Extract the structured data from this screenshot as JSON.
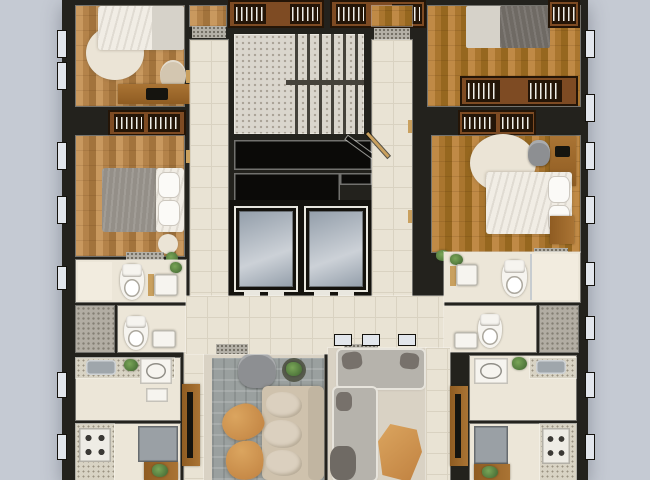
{
  "scene": {
    "type": "residential-floor-plan-3d-top-view",
    "core": {
      "features": [
        "staircase-two-flights",
        "stair-void",
        "elevator-shaft",
        "elevator-shaft"
      ],
      "elevator_count": 2
    },
    "circulation": [
      "left-corridor",
      "right-corridor",
      "lobby",
      "door-mats",
      "open-door-leaf"
    ],
    "rooms": [
      {
        "name": "bedroom-top-left",
        "furniture": [
          "double-bed",
          "round-rug",
          "desk",
          "laptop",
          "desk-chair",
          "plant"
        ]
      },
      {
        "name": "bedroom-mid-left",
        "furniture": [
          "wardrobe-hangers",
          "double-bed-gray-blanket",
          "stool",
          "plant",
          "door-mat"
        ]
      },
      {
        "name": "bathroom-left-1",
        "furniture": [
          "shower",
          "toilet",
          "vanity-sink",
          "plant"
        ]
      },
      {
        "name": "bathroom-left-2",
        "furniture": [
          "toilet",
          "vanity-sink"
        ]
      },
      {
        "name": "laundry-left",
        "furniture": [
          "counter",
          "steel-sink",
          "plant",
          "washer",
          "appliance"
        ]
      },
      {
        "name": "kitchen-left",
        "furniture": [
          "counter",
          "stove-4-burners",
          "fridge",
          "plant-stand"
        ]
      },
      {
        "name": "living-room-left",
        "furniture": [
          "plaid-rug",
          "armchair",
          "plant-table",
          "three-seat-sofa",
          "coffee-table",
          "coffee-table",
          "tv-console",
          "tv"
        ]
      },
      {
        "name": "living-room-right",
        "furniture": [
          "l-shaped-sofa",
          "pillows",
          "coffee-table",
          "lounge-chair",
          "tv-console",
          "tv"
        ]
      },
      {
        "name": "bedroom-top-right",
        "furniture": [
          "double-bed-dark-blanket",
          "wardrobe-hangers",
          "corner-closet"
        ]
      },
      {
        "name": "bedroom-mid-right",
        "furniture": [
          "wardrobe-hangers",
          "round-rug",
          "double-bed",
          "desk",
          "laptop",
          "desk-chair",
          "nightstand",
          "plant",
          "door-mat"
        ]
      },
      {
        "name": "bathroom-right-1",
        "furniture": [
          "plant",
          "vanity-sink",
          "toilet",
          "glass-shower"
        ]
      },
      {
        "name": "bathroom-right-2",
        "furniture": [
          "toilet",
          "vanity-sink"
        ]
      },
      {
        "name": "laundry-right",
        "furniture": [
          "washer",
          "plant",
          "counter",
          "steel-sink"
        ]
      },
      {
        "name": "kitchen-right",
        "furniture": [
          "fridge",
          "stove-4-burners",
          "counter",
          "plant-stand"
        ]
      },
      {
        "name": "service-shaft-left",
        "furniture": []
      },
      {
        "name": "service-shaft-right",
        "furniture": []
      },
      {
        "name": "top-center-closet-left",
        "furniture": [
          "wardrobe-hangers"
        ]
      },
      {
        "name": "top-center-closet-right",
        "furniture": [
          "wardrobe-hangers"
        ]
      }
    ],
    "window_count": 16
  },
  "palette": {
    "bg": "#c5cad3",
    "wall": "#23221d",
    "wallDeep": "#14120d",
    "tile": "#e9e3d4",
    "tileLine": "#d9d2c1",
    "cream": "#ece6d8",
    "cream2": "#f2ecdf",
    "terrazzo": "#dad6cd",
    "terrazzoDot": "#a7a093",
    "tread": "#45423b",
    "voidBlack": "#0b0a08",
    "elevFrame": "#e9e7df",
    "elevCarA": "#939eaa",
    "elevCarB": "#ccd1d7",
    "cabinet": "#7e4b23",
    "cabinetDark": "#241507",
    "jamb": "#c9a05e",
    "mat": "#b4b0a7",
    "matDot": "#716d63",
    "counter": "#d8d3c4",
    "shaft": "#b2ada3",
    "shaftDot": "#847f74",
    "winGlass": "#e2e6ec",
    "porcelain": "#f6f4ef",
    "steel": "#9fa6ab",
    "appliance": "#eeece5",
    "applianceEdge": "#c5c2ba",
    "fridge": "#9aa0a5",
    "burner": "#3b3935",
    "tv": "#15140f",
    "desk": "#aa7434",
    "deskB": "#8f5c22",
    "woodA": "#c9995f",
    "woodB": "#b4834a",
    "woodC": "#a2733c",
    "woodD": "#c08a46",
    "woodE": "#aa762f",
    "woodF": "#96671f",
    "linen": "#f1ede5",
    "sheetGray": "#d6d2c9",
    "blanketGray": "#948f88",
    "blanketDark": "#6f6a64",
    "creamRug": "#ebe4d6",
    "rugGray": "#9aa09f",
    "beigeFloor": "#d9d2c4",
    "sofaBeige": "#cfc2ad",
    "cushion": "#dbd0bf",
    "cushionEdge": "#c1b5a1",
    "sofaGray": "#b6b3ac",
    "sofaRim": "#e7e4dc",
    "pillowDark": "#77716b",
    "chairGray": "#8d8f92",
    "chairBeige": "#d3c6b0",
    "orangeA": "#dba55f",
    "orangeB": "#c08140",
    "greenA": "#79a557",
    "greenB": "#3e6330",
    "potOlive": "#565a4c"
  }
}
